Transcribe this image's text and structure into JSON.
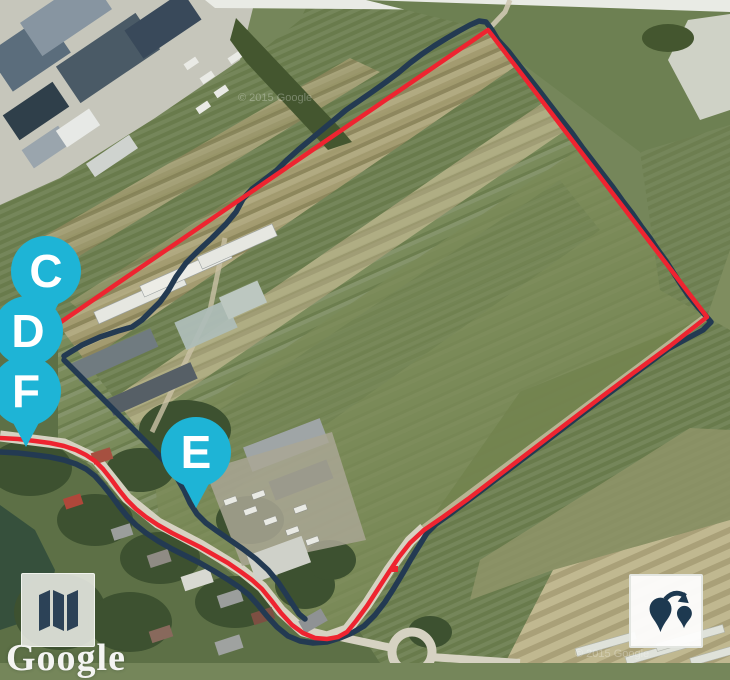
{
  "map": {
    "attribution_logo": "Google",
    "watermarks": [
      "© 2015 Google",
      "© 2015 Google"
    ],
    "marker_color": "#1eb4d6",
    "marker_label_color": "#ffffff",
    "markers": [
      {
        "label": "C",
        "x": 46,
        "y": 271
      },
      {
        "label": "D",
        "x": 28,
        "y": 331
      },
      {
        "label": "F",
        "x": 26,
        "y": 391
      },
      {
        "label": "E",
        "x": 196,
        "y": 452
      }
    ],
    "routes": {
      "planned": {
        "color": "#ee2430",
        "width": 4.5,
        "points": [
          [
            58,
            324
          ],
          [
            488,
            30
          ],
          [
            707,
            317
          ],
          [
            670,
            346
          ],
          [
            636,
            371
          ],
          [
            600,
            398
          ],
          [
            566,
            424
          ],
          [
            532,
            450
          ],
          [
            498,
            476
          ],
          [
            468,
            499
          ],
          [
            443,
            517
          ],
          [
            424,
            530
          ],
          [
            410,
            543
          ],
          [
            399,
            557
          ],
          [
            389,
            572
          ],
          [
            378,
            589
          ],
          [
            367,
            606
          ],
          [
            356,
            621
          ],
          [
            347,
            632
          ],
          [
            338,
            637
          ],
          [
            327,
            639
          ],
          [
            315,
            638
          ],
          [
            303,
            633
          ],
          [
            292,
            625
          ],
          [
            281,
            613
          ],
          [
            271,
            600
          ],
          [
            262,
            589
          ],
          [
            252,
            580
          ],
          [
            241,
            572
          ],
          [
            228,
            563
          ],
          [
            214,
            555
          ],
          [
            200,
            547
          ],
          [
            186,
            540
          ],
          [
            172,
            533
          ],
          [
            158,
            525
          ],
          [
            146,
            517
          ],
          [
            136,
            509
          ],
          [
            127,
            500
          ],
          [
            119,
            490
          ],
          [
            111,
            479
          ],
          [
            103,
            469
          ],
          [
            95,
            461
          ],
          [
            86,
            455
          ],
          [
            76,
            450
          ],
          [
            64,
            446
          ],
          [
            50,
            443
          ],
          [
            35,
            441
          ],
          [
            18,
            439
          ],
          [
            0,
            438
          ]
        ]
      },
      "track": {
        "color": "#233a52",
        "width": 5.5,
        "segments": [
          [
            [
              64,
              356
            ],
            [
              82,
              345
            ],
            [
              100,
              337
            ],
            [
              118,
              331
            ],
            [
              132,
              327
            ],
            [
              142,
              320
            ],
            [
              148,
              314
            ],
            [
              160,
              302
            ],
            [
              168,
              291
            ],
            [
              176,
              277
            ],
            [
              186,
              263
            ],
            [
              198,
              251
            ],
            [
              212,
              238
            ],
            [
              226,
              224
            ],
            [
              236,
              212
            ],
            [
              243,
              199
            ],
            [
              252,
              189
            ],
            [
              264,
              180
            ],
            [
              277,
              170
            ],
            [
              288,
              159
            ],
            [
              298,
              150
            ],
            [
              310,
              140
            ],
            [
              322,
              130
            ],
            [
              334,
              120
            ],
            [
              346,
              110
            ],
            [
              359,
              101
            ],
            [
              372,
              92
            ],
            [
              386,
              82
            ],
            [
              398,
              73
            ],
            [
              410,
              63
            ],
            [
              422,
              54
            ],
            [
              434,
              46
            ],
            [
              447,
              38
            ],
            [
              459,
              31
            ],
            [
              470,
              25
            ],
            [
              479,
              21
            ],
            [
              486,
              22
            ],
            [
              492,
              30
            ],
            [
              498,
              40
            ],
            [
              509,
              52
            ],
            [
              519,
              65
            ],
            [
              530,
              79
            ],
            [
              541,
              93
            ],
            [
              551,
              106
            ],
            [
              561,
              119
            ],
            [
              572,
              133
            ],
            [
              582,
              147
            ],
            [
              592,
              160
            ],
            [
              602,
              173
            ],
            [
              612,
              186
            ],
            [
              622,
              200
            ],
            [
              632,
              213
            ],
            [
              641,
              226
            ],
            [
              650,
              238
            ],
            [
              658,
              250
            ],
            [
              666,
              261
            ],
            [
              673,
              272
            ],
            [
              680,
              283
            ],
            [
              688,
              295
            ],
            [
              697,
              306
            ],
            [
              705,
              315
            ],
            [
              711,
              322
            ],
            [
              703,
              330
            ],
            [
              688,
              338
            ],
            [
              668,
              349
            ],
            [
              645,
              366
            ],
            [
              620,
              385
            ],
            [
              596,
              403
            ],
            [
              570,
              423
            ],
            [
              545,
              442
            ],
            [
              520,
              461
            ],
            [
              495,
              480
            ],
            [
              470,
              499
            ],
            [
              450,
              514
            ],
            [
              436,
              524
            ],
            [
              427,
              533
            ],
            [
              419,
              546
            ],
            [
              411,
              559
            ],
            [
              403,
              573
            ],
            [
              394,
              588
            ],
            [
              385,
              602
            ],
            [
              375,
              615
            ],
            [
              364,
              626
            ],
            [
              352,
              633
            ],
            [
              340,
              638
            ],
            [
              327,
              642
            ],
            [
              313,
              643
            ],
            [
              300,
              641
            ],
            [
              288,
              636
            ],
            [
              277,
              627
            ],
            [
              267,
              616
            ],
            [
              258,
              605
            ],
            [
              249,
              595
            ],
            [
              239,
              587
            ],
            [
              227,
              579
            ],
            [
              214,
              571
            ],
            [
              200,
              563
            ],
            [
              186,
              556
            ],
            [
              172,
              549
            ],
            [
              158,
              541
            ],
            [
              146,
              533
            ],
            [
              136,
              525
            ],
            [
              127,
              516
            ],
            [
              119,
              506
            ],
            [
              111,
              495
            ],
            [
              103,
              485
            ],
            [
              95,
              476
            ],
            [
              86,
              469
            ],
            [
              76,
              464
            ],
            [
              64,
              460
            ],
            [
              50,
              457
            ],
            [
              35,
              455
            ],
            [
              18,
              453
            ],
            [
              0,
              452
            ]
          ],
          [
            [
              64,
              360
            ],
            [
              80,
              376
            ],
            [
              96,
              392
            ],
            [
              112,
              408
            ],
            [
              127,
              423
            ],
            [
              141,
              437
            ],
            [
              154,
              450
            ],
            [
              166,
              463
            ],
            [
              176,
              476
            ],
            [
              184,
              490
            ],
            [
              190,
              503
            ],
            [
              197,
              514
            ],
            [
              206,
              523
            ],
            [
              217,
              531
            ],
            [
              230,
              540
            ],
            [
              243,
              549
            ],
            [
              256,
              559
            ],
            [
              268,
              570
            ],
            [
              278,
              582
            ],
            [
              286,
              594
            ],
            [
              293,
              605
            ],
            [
              299,
              614
            ],
            [
              305,
              619
            ]
          ]
        ]
      },
      "dot": {
        "color": "#ee2430",
        "x": 392,
        "y": 566,
        "size": 6
      }
    }
  },
  "controls": {
    "map_type_button": {
      "icon": "folded-map-icon"
    },
    "markers_button": {
      "icon": "map-pins-arrow-icon"
    }
  }
}
